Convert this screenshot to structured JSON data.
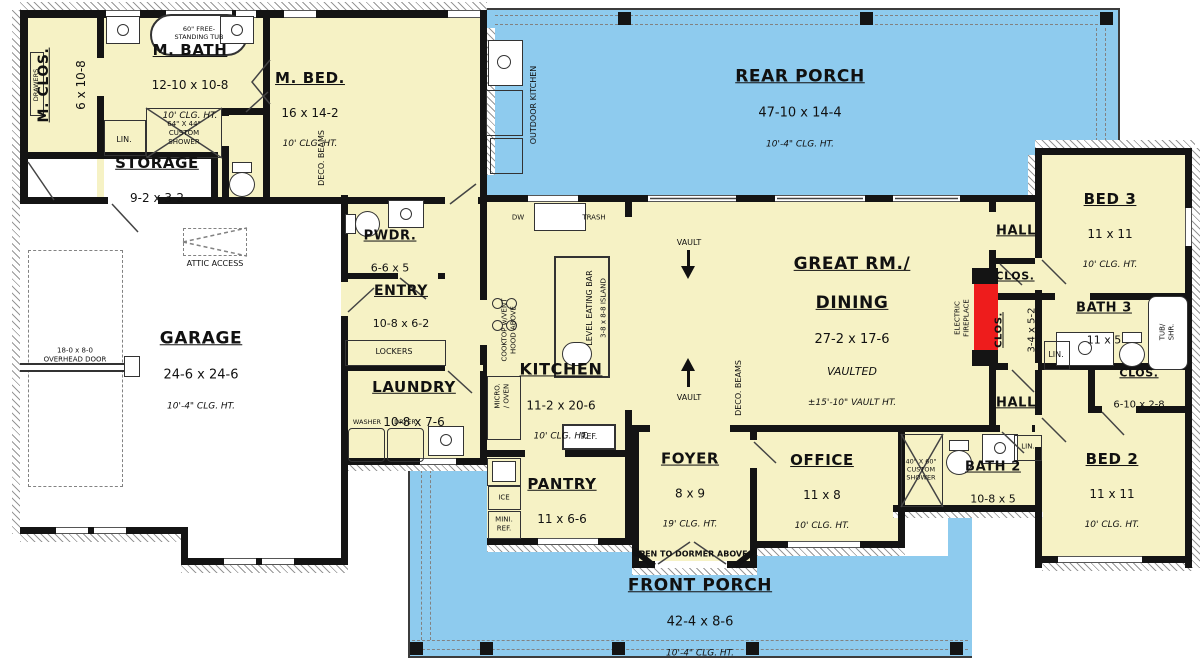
{
  "colors": {
    "room_fill": "#f6f2c5",
    "porch_fill": "#8ecbee",
    "wall": "#141414",
    "fireplace_red": "#ee1c1c"
  },
  "rooms": {
    "m_clos": {
      "name": "M. CLOS.",
      "dims": "6 x 10-8"
    },
    "m_bath": {
      "name": "M. BATH",
      "dims": "12-10 x 10-8",
      "clg": "10' CLG. HT."
    },
    "m_bed": {
      "name": "M. BED.",
      "dims": "16 x 14-2",
      "clg": "10' CLG. HT."
    },
    "storage": {
      "name": "STORAGE",
      "dims": "9-2 x 3-2"
    },
    "rear_porch": {
      "name": "REAR PORCH",
      "dims": "47-10 x 14-4",
      "clg": "10'-4\" CLG. HT."
    },
    "pwdr": {
      "name": "PWDR.",
      "dims": "6-6 x 5"
    },
    "entry": {
      "name": "ENTRY",
      "dims": "10-8 x 6-2"
    },
    "garage": {
      "name": "GARAGE",
      "dims": "24-6 x 24-6",
      "clg": "10'-4\" CLG. HT."
    },
    "laundry": {
      "name": "LAUNDRY",
      "dims": "10-8 x 7-6"
    },
    "kitchen": {
      "name": "KITCHEN",
      "dims": "11-2 x 20-6",
      "clg": "10' CLG. HT."
    },
    "great_rm": {
      "name1": "GREAT RM./",
      "name2": "DINING",
      "dims": "27-2 x 17-6",
      "sub": "VAULTED",
      "clg": "±15'-10\" VAULT HT."
    },
    "foyer": {
      "name": "FOYER",
      "dims": "8 x 9",
      "clg": "19' CLG. HT.",
      "note": "OPEN TO DORMER ABOVE"
    },
    "office": {
      "name": "OFFICE",
      "dims": "11 x 8",
      "clg": "10' CLG. HT."
    },
    "pantry": {
      "name": "PANTRY",
      "dims": "11 x 6-6"
    },
    "front_porch": {
      "name": "FRONT PORCH",
      "dims": "42-4 x 8-6",
      "clg": "10'-4\" CLG. HT."
    },
    "bed3": {
      "name": "BED 3",
      "dims": "11 x 11",
      "clg": "10' CLG. HT."
    },
    "bath3": {
      "name": "BATH 3",
      "dims": "11 x 5"
    },
    "bed2": {
      "name": "BED 2",
      "dims": "11 x 11",
      "clg": "10' CLG. HT."
    },
    "bath2": {
      "name": "BATH 2",
      "dims": "10-8 x 5"
    },
    "hall_upper": {
      "name": "HALL"
    },
    "hall_lower": {
      "name": "HALL"
    },
    "clos_hall": {
      "name": "CLOS."
    },
    "clos_342": {
      "name": "CLOS.",
      "dims": "3-4 x 5-2"
    },
    "clos_610": {
      "name": "CLOS.",
      "dims": "6-10 x 2-8"
    }
  },
  "annotations": {
    "tub": "60\" FREE-\nSTANDING TUB",
    "m_shower": "64\" X 44\"\nCUSTOM\nSHOWER",
    "b2_shower": "40\" X 60\"\nCUSTOM\nSHOWER",
    "lin": "LIN.",
    "drawers": "DRAWERS",
    "attic": "ATTIC ACCESS",
    "overhead_door": "18-0 x 8-0\nOVERHEAD DOOR",
    "deco_beams": "DECO. BEAMS",
    "outdoor_kitchen": "OUTDOOR KITCHEN",
    "dw": "DW",
    "trash": "TRASH",
    "ref": "REF.",
    "ice": "ICE",
    "mini_ref": "MINI.\nREF.",
    "micro_oven": "MICRO.\n/ OVEN",
    "cooktop": "COOKTOP w/VENT\nHOOD ABOVE",
    "eating_bar": "LEVEL EATING BAR",
    "island": "3-8 x 8-8 ISLAND",
    "lockers": "LOCKERS",
    "washer": "WASHER",
    "dryer": "DRYER",
    "vault": "VAULT",
    "fireplace": "ELECTRIC\nFIREPLACE",
    "tub_shr": "TUB/ SHR."
  }
}
